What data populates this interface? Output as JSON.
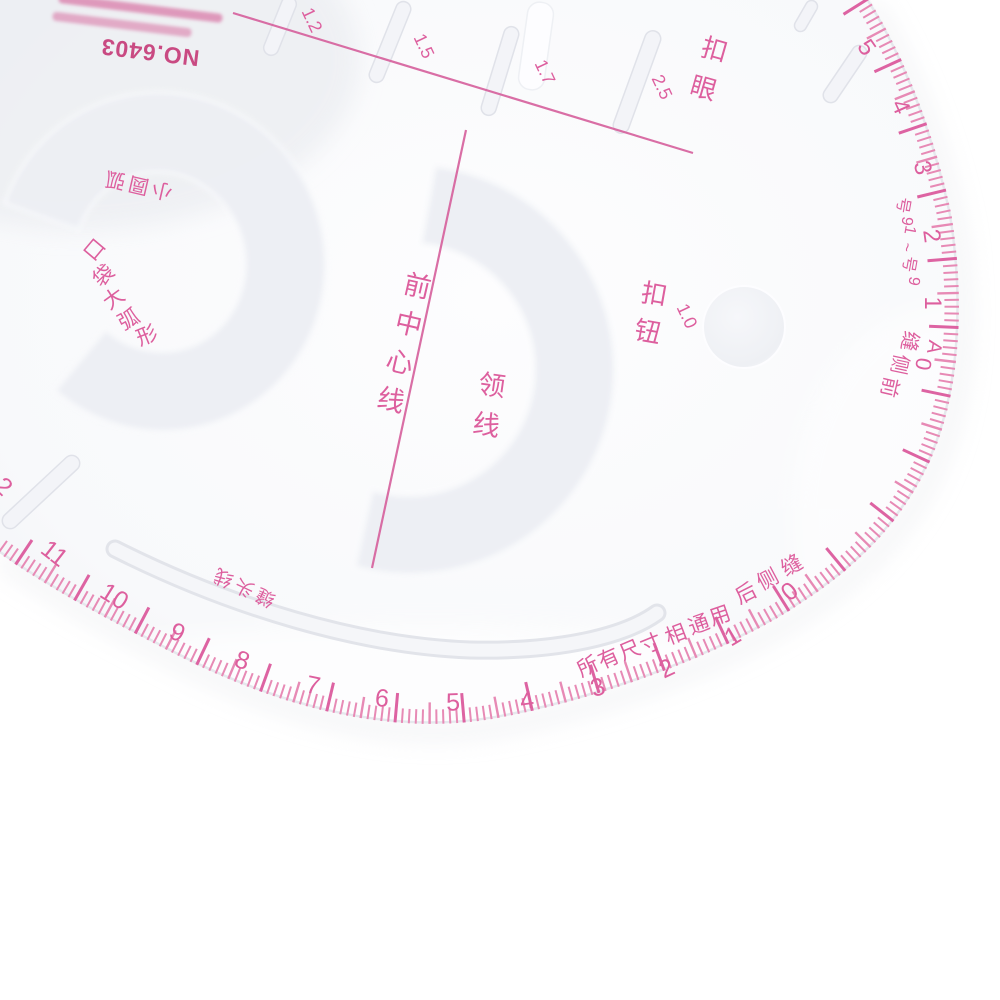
{
  "product": {
    "model_number": "NO.6403"
  },
  "ink_colors": {
    "print_pink": "#dd5f9e",
    "print_deep": "#c94a82",
    "tick_minor": "#e78ab5",
    "tick_major": "#dd63a2"
  },
  "labels": {
    "buttonhole": "扣眼",
    "button": "钮扣",
    "front_center_line": "前中心线",
    "collar_line": "领线",
    "pocket_big_arc": "口袋大弧形",
    "pocket_small_arc": "小圆弧",
    "seam_allowance_line": "缝头线",
    "all_sizes_common": "所有尺寸相通用",
    "front_side_seam": "前侧缝",
    "back_side_seam": "后侧缝",
    "size_range": "9号~19号",
    "origin_marker_zero": "0",
    "origin_marker_a": "A"
  },
  "buttonhole_scale": {
    "values": [
      "1.2",
      "1.5",
      "1.7",
      "2.5"
    ]
  },
  "button_size": "1.0",
  "edge_scales": {
    "right": [
      "5",
      "4",
      "3",
      "2",
      "1"
    ],
    "bottom": [
      "0",
      "1",
      "2",
      "3",
      "4",
      "5",
      "6",
      "7",
      "8",
      "9",
      "10",
      "11"
    ],
    "left_partial": "2"
  }
}
